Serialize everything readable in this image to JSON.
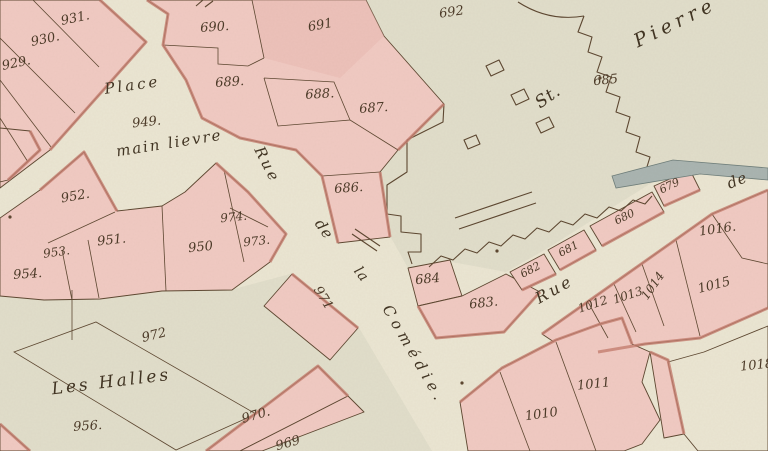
{
  "map": {
    "kind": "historical cadastral map sheet",
    "palette": {
      "paper": "#ebe6d3",
      "zone": "#e1decb",
      "pink": "#f1cac3",
      "pinkdark": "#eab9b2",
      "red": "#c67e70",
      "line": "#5b452f",
      "ink": "#4a3826",
      "inkstreet": "#3e3120",
      "blue": "#a9b4b1"
    },
    "street_labels": [
      {
        "id": "place",
        "text": "Place",
        "x": 133,
        "y": 90,
        "rot": -8,
        "size": 15,
        "ls": 3
      },
      {
        "id": "mainlievre",
        "text": "main lievre",
        "x": 170,
        "y": 148,
        "rot": -9,
        "size": 15,
        "ls": 2
      },
      {
        "id": "rue-comedie-rue",
        "text": "Rue",
        "x": 263,
        "y": 167,
        "rot": 63,
        "size": 15,
        "ls": 3
      },
      {
        "id": "rue-comedie-de",
        "text": "de",
        "x": 320,
        "y": 232,
        "rot": 56,
        "size": 15,
        "ls": 1
      },
      {
        "id": "rue-comedie-la",
        "text": "la",
        "x": 358,
        "y": 277,
        "rot": 52,
        "size": 14,
        "ls": 1
      },
      {
        "id": "rue-comedie-word",
        "text": "Comédie.",
        "x": 410,
        "y": 357,
        "rot": 60,
        "size": 15,
        "ls": 5
      },
      {
        "id": "st-pierre-st",
        "text": "St.",
        "x": 551,
        "y": 101,
        "rot": -35,
        "size": 17,
        "ls": 1
      },
      {
        "id": "st-pierre-pierre",
        "text": "Pierre",
        "x": 678,
        "y": 28,
        "rot": -26,
        "size": 19,
        "ls": 5
      },
      {
        "id": "rue-de-rue",
        "text": "Rue",
        "x": 557,
        "y": 294,
        "rot": -29,
        "size": 16,
        "ls": 3
      },
      {
        "id": "rue-de-de",
        "text": "de",
        "x": 739,
        "y": 185,
        "rot": -22,
        "size": 15,
        "ls": 1
      },
      {
        "id": "les-halles",
        "text": "Les Halles",
        "x": 112,
        "y": 387,
        "rot": -7,
        "size": 17,
        "ls": 3
      }
    ],
    "parcel_numbers": [
      {
        "text": "931.",
        "x": 76,
        "y": 22,
        "rot": -12
      },
      {
        "text": "930.",
        "x": 46,
        "y": 43,
        "rot": -12
      },
      {
        "text": "929.",
        "x": 17,
        "y": 67,
        "rot": -12
      },
      {
        "text": "690.",
        "x": 215,
        "y": 31,
        "rot": -4
      },
      {
        "text": "691",
        "x": 321,
        "y": 29,
        "rot": -10
      },
      {
        "text": "692",
        "x": 452,
        "y": 16,
        "rot": -8
      },
      {
        "text": "689.",
        "x": 230,
        "y": 86,
        "rot": -4
      },
      {
        "text": "688.",
        "x": 320,
        "y": 98,
        "rot": -3
      },
      {
        "text": "687.",
        "x": 374,
        "y": 112,
        "rot": -4
      },
      {
        "text": "686.",
        "x": 349,
        "y": 192,
        "rot": -4
      },
      {
        "text": "685",
        "x": 606,
        "y": 84,
        "rot": -6
      },
      {
        "text": "684",
        "x": 428,
        "y": 283,
        "rot": -6
      },
      {
        "text": "683.",
        "x": 484,
        "y": 307,
        "rot": -6
      },
      {
        "text": "682",
        "x": 532,
        "y": 273,
        "rot": -28,
        "size": 11
      },
      {
        "text": "681",
        "x": 570,
        "y": 252,
        "rot": -28,
        "size": 11
      },
      {
        "text": "680",
        "x": 626,
        "y": 220,
        "rot": -26,
        "size": 11
      },
      {
        "text": "679",
        "x": 671,
        "y": 189,
        "rot": -26,
        "size": 11
      },
      {
        "text": "949.",
        "x": 147,
        "y": 126,
        "rot": -6
      },
      {
        "text": "952.",
        "x": 76,
        "y": 200,
        "rot": -10
      },
      {
        "text": "953.",
        "x": 57,
        "y": 256,
        "rot": -8,
        "size": 12
      },
      {
        "text": "954.",
        "x": 28,
        "y": 278,
        "rot": -4
      },
      {
        "text": "951.",
        "x": 112,
        "y": 244,
        "rot": -6
      },
      {
        "text": "950",
        "x": 201,
        "y": 251,
        "rot": -6
      },
      {
        "text": "974.",
        "x": 234,
        "y": 221,
        "rot": -6,
        "size": 12
      },
      {
        "text": "973.",
        "x": 257,
        "y": 245,
        "rot": -6,
        "size": 12
      },
      {
        "text": "971",
        "x": 320,
        "y": 300,
        "rot": 58
      },
      {
        "text": "972",
        "x": 155,
        "y": 339,
        "rot": -14
      },
      {
        "text": "956.",
        "x": 88,
        "y": 430,
        "rot": -4
      },
      {
        "text": "970.",
        "x": 257,
        "y": 419,
        "rot": -16
      },
      {
        "text": "969",
        "x": 289,
        "y": 447,
        "rot": -16
      },
      {
        "text": "1016.",
        "x": 718,
        "y": 233,
        "rot": -8
      },
      {
        "text": "1015",
        "x": 715,
        "y": 289,
        "rot": -14
      },
      {
        "text": "1014",
        "x": 656,
        "y": 288,
        "rot": -55,
        "size": 12
      },
      {
        "text": "1013",
        "x": 629,
        "y": 299,
        "rot": -18,
        "size": 12
      },
      {
        "text": "1012",
        "x": 594,
        "y": 308,
        "rot": -18,
        "size": 12
      },
      {
        "text": "1011",
        "x": 594,
        "y": 388,
        "rot": -6
      },
      {
        "text": "1010",
        "x": 542,
        "y": 418,
        "rot": -8
      },
      {
        "text": "1018",
        "x": 757,
        "y": 369,
        "rot": -6
      }
    ]
  }
}
